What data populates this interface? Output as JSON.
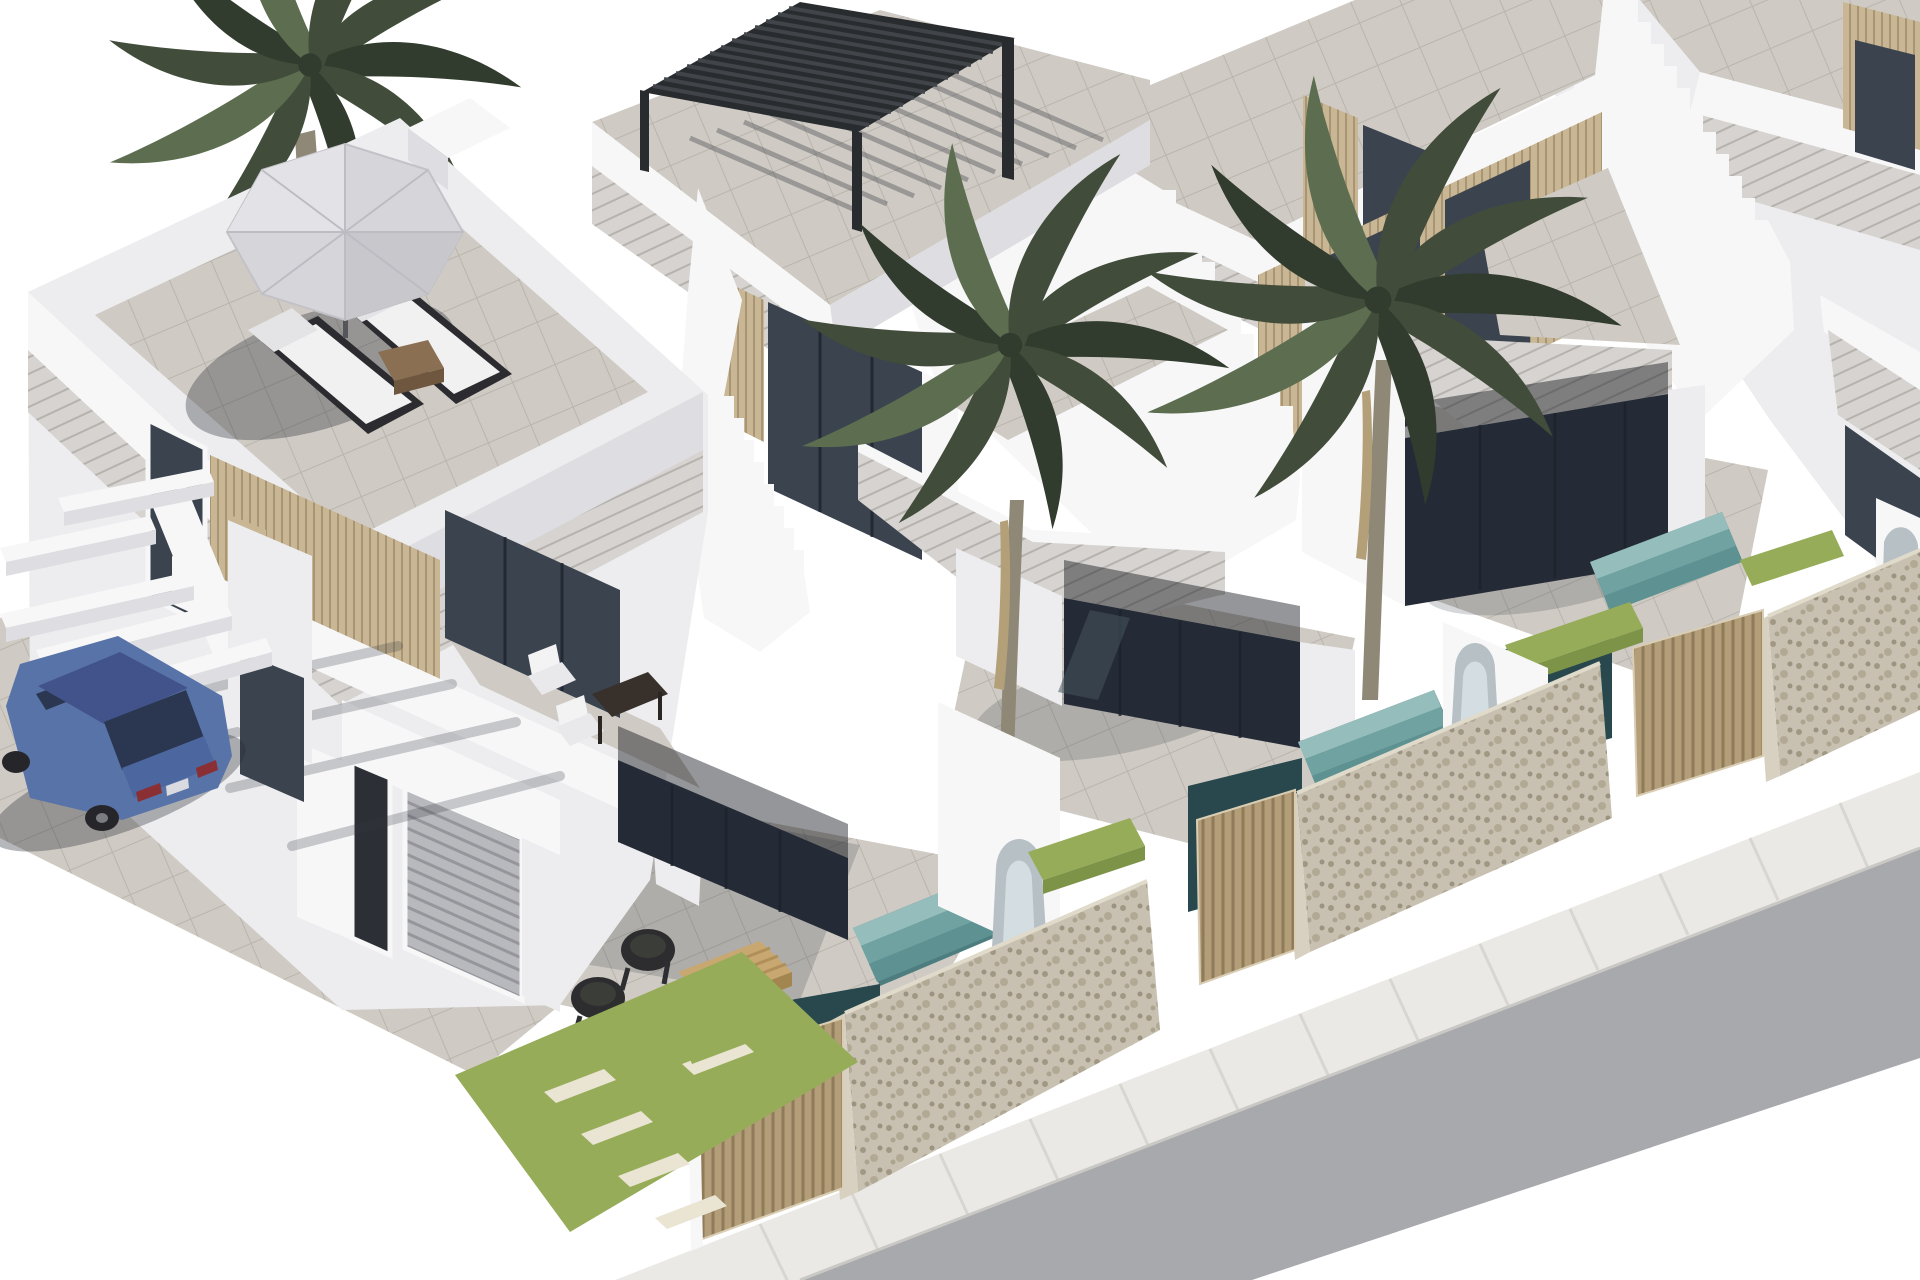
{
  "meta": {
    "title": "Isometric 3D architectural rendering of a row of modern white terraced villas",
    "image_type": "computer-generated exterior visualisation, no text or UI elements"
  },
  "palette": {
    "bg": "#ffffff",
    "white_lit": "#f7f7f8",
    "white_soft": "#ededef",
    "white_shade": "#dedee2",
    "white_deep": "#cdced3",
    "stone_band": "#d6d3d0",
    "stone_line": "#bbb7b2",
    "tile": "#cfcbc4",
    "tile_shade": "#bab6ae",
    "tile_line": "#b3afa7",
    "glass": "#3b434f",
    "glass_dark": "#252b36",
    "glass_light": "#5d6873",
    "glass_frame": "#aab0b6",
    "wood": "#c8b694",
    "wood_line": "#9c8a64",
    "gate": "#b39e79",
    "gate_line": "#8a7552",
    "pergola": "#292c2f",
    "pergola_line": "#41454a",
    "palm": "#414c3a",
    "palm_dark": "#313c2e",
    "palm_light": "#5d6e50",
    "trunk": "#8f8876",
    "dryfrond": "#b3a078",
    "pool": "#4e7d7f",
    "pool_step": "#95bdbb",
    "pool_step2": "#6fa2a1",
    "pool_step3": "#5e9191",
    "pool_dark": "#28484d",
    "stonewall": "#c8c0b0",
    "stonewall_end": "#d8d1c2",
    "stonewall_line": "#9a8f7a",
    "grass": "#96ac58",
    "grass_shade": "#7d9348",
    "slab": "#eae4d3",
    "road": "#a8a9ad",
    "walk": "#ebe9e5",
    "curb": "#c9c8c4",
    "car_body": "#5873a7",
    "car_dark": "#41538a",
    "car_glass": "#2b3750",
    "car_wheel": "#26262a",
    "car_light": "#8a2f33",
    "shadow": "rgba(52,55,65,0.20)",
    "shadow_dark": "rgba(40,43,53,0.34)"
  },
  "scene": {
    "villas": [
      {
        "name": "villa-1",
        "position": "foreground left",
        "features": [
          "roof terrace with grey parasol",
          "two sun loungers",
          "timber side table",
          "first-floor balcony with two white chairs and dark table",
          "timber slat cladding",
          "garage with grey sectional door",
          "carport with white beams",
          "ground-floor patio with two wicker chairs and timber coffee table",
          "plunge pool with steps",
          "lawn with stepping slabs",
          "timber entrance gate",
          "gabion stone wall"
        ]
      },
      {
        "name": "villa-2",
        "position": "centre",
        "features": [
          "roof terrace with black louvered pergola",
          "external staircase with stepped parapet",
          "timber slat cladding",
          "full-height dark glazing",
          "front yard with palm tree",
          "plunge pool with steps and waterfall spout",
          "grass planters",
          "timber gate",
          "gabion stone wall"
        ]
      },
      {
        "name": "villa-3",
        "position": "right",
        "features": [
          "roof terrace",
          "external staircase with stepped parapet",
          "timber slat cladding",
          "full-height dark glazing",
          "front yard with palm tree",
          "plunge pool with steps and waterfall spout",
          "grass planters",
          "timber gate",
          "gabion stone wall"
        ]
      },
      {
        "name": "villa-4",
        "position": "far right, partially cropped",
        "features": [
          "roof terrace",
          "timber slat cladding",
          "dark glazing"
        ]
      }
    ],
    "environment": {
      "palm_trees": 3,
      "pools": 3,
      "street": "grey asphalt road with light paved sidewalk running diagonally bottom-right",
      "vehicle": {
        "type": "sedan car",
        "color_name": "blue",
        "location": "parked under villa-1 carport"
      }
    }
  }
}
